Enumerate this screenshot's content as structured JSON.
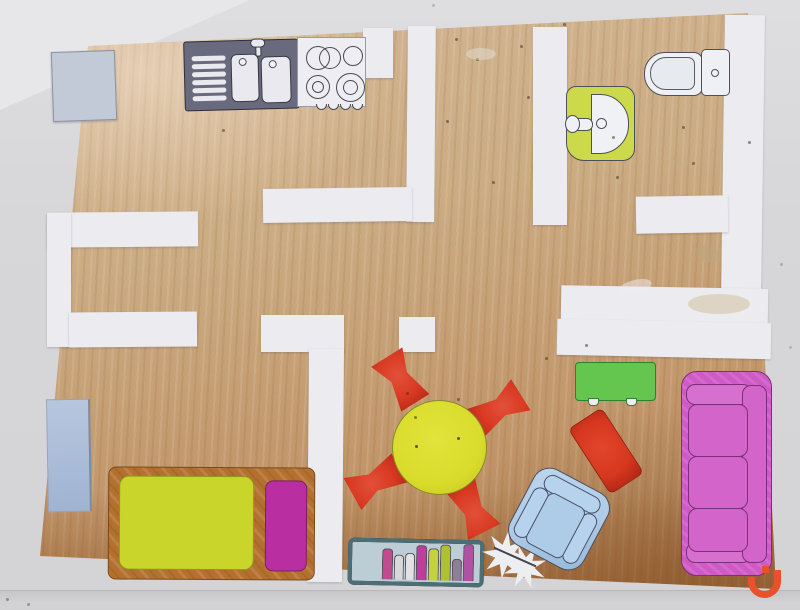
{
  "palette": {
    "background": "#d7d7d9",
    "wood": "#c8a87e",
    "wall_paper": "#ebebf0",
    "outline": "#4f4f5a",
    "logo_orange": "#e8512b"
  },
  "items": {
    "fridge": {
      "color": "#c2cad7"
    },
    "kitchen_sink_unit": {
      "color": "#696a7e"
    },
    "stove": {
      "color": "#ededf2"
    },
    "bath_sink": {
      "color": "#ccd94b"
    },
    "toilet": {
      "color": "#eef0f4"
    },
    "blue_rug": {
      "color": "#aabfdc"
    },
    "bed_frame": {
      "color": "#b4702e"
    },
    "mattress": {
      "color": "#c9d52b"
    },
    "pillow": {
      "color": "#b92fa2"
    },
    "dining_table": {
      "color": "#d9dc2b"
    },
    "dining_chair": {
      "color": "#d93a22"
    },
    "green_table": {
      "color": "#64c64e"
    },
    "red_armchair": {
      "color": "#d6371f"
    },
    "blue_armchair": {
      "color": "#aecbe7"
    },
    "pink_sofa": {
      "color": "#cf5ac6"
    },
    "bookshelf_frame": {
      "color": "#4e6e76"
    },
    "bookshelf_shelf": {
      "color": "#bccdd6"
    },
    "starburst": {
      "color": "#eceef2"
    },
    "books": [
      "#c24a8e",
      "#d8d8da",
      "#e2e2e4",
      "#bb3f9b",
      "#c4d23c",
      "#aec22f",
      "#8e7f96",
      "#b052a4"
    ]
  }
}
